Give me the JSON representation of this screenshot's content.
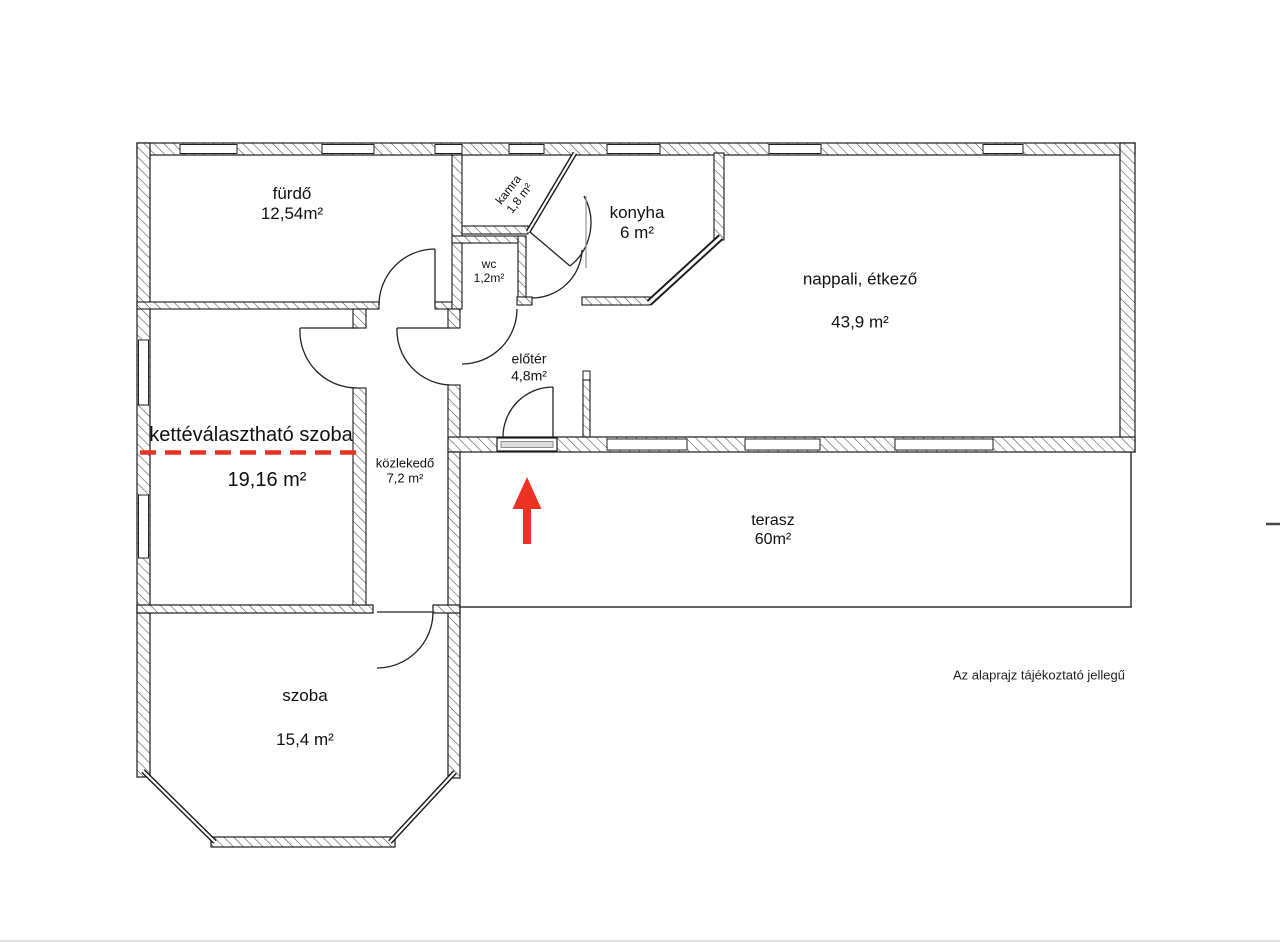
{
  "title": "alaprajz",
  "rooms": {
    "furdo": {
      "name": "fürdő",
      "area": "12,54m²"
    },
    "kamra": {
      "name": "kamra",
      "area": "1,8 m²"
    },
    "konyha": {
      "name": "konyha",
      "area": "6 m²"
    },
    "wc": {
      "name": "wc",
      "area": "1,2m²"
    },
    "eloter": {
      "name": "előtér",
      "area": "4,8m²"
    },
    "nappali": {
      "name": "nappali, étkező",
      "area": "43,9 m²"
    },
    "kettevalaszthato": {
      "name": "kettéválasztható szoba",
      "area": "19,16 m²"
    },
    "kozlekedo": {
      "name": "közlekedő",
      "area": "7,2 m²"
    },
    "terasz": {
      "name": "terasz",
      "area": "60m²"
    },
    "szoba": {
      "name": "szoba",
      "area": "15,4 m²"
    }
  },
  "annotations": {
    "disclaimer": "Az alaprajz tájékoztató jellegű"
  },
  "colors": {
    "accent_red": "#ec3323",
    "wall_line": "#1a1a1a"
  },
  "icons": {
    "entrance_arrow": "up-arrow-icon"
  }
}
